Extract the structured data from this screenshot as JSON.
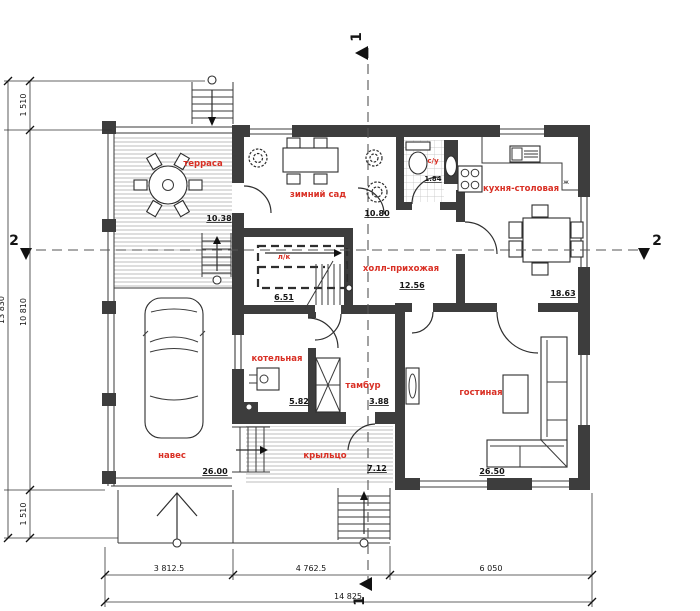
{
  "rooms": {
    "terrace": {
      "label": "терраса",
      "area": "10.38"
    },
    "winter_garden": {
      "label": "зимний сад",
      "area": "10.80"
    },
    "wc": {
      "label": "с/у",
      "area": "1.84"
    },
    "kitchen": {
      "label": "кухня-столовая",
      "area": "18.63"
    },
    "stairs": {
      "label": "л/к",
      "area": "6.51"
    },
    "hall": {
      "label": "холл-прихожая",
      "area": "12.56"
    },
    "boiler": {
      "label": "котельная",
      "area": "5.82"
    },
    "tambour": {
      "label": "тамбур",
      "area": "3.88"
    },
    "carport": {
      "label": "навес",
      "area": "26.00"
    },
    "porch": {
      "label": "крыльцо",
      "area": "7.12"
    },
    "living": {
      "label": "гостиная",
      "area": "26.50"
    }
  },
  "sections": {
    "s1": "1",
    "s2": "2"
  },
  "dims": {
    "left_top": "1 510",
    "left_mid": "10 810",
    "left_bottom": "1 510",
    "left_total": "13 830",
    "bottom_1": "3 812.5",
    "bottom_2": "4 762.5",
    "bottom_3": "6 050",
    "bottom_total": "14 825"
  },
  "symbols": {
    "kitchen_mark": "ж"
  },
  "colors": {
    "wall": "#3d3d3d",
    "room_label": "#d93025",
    "line": "#2e2e2e",
    "hatch": "#adadad",
    "background": "#ffffff"
  }
}
